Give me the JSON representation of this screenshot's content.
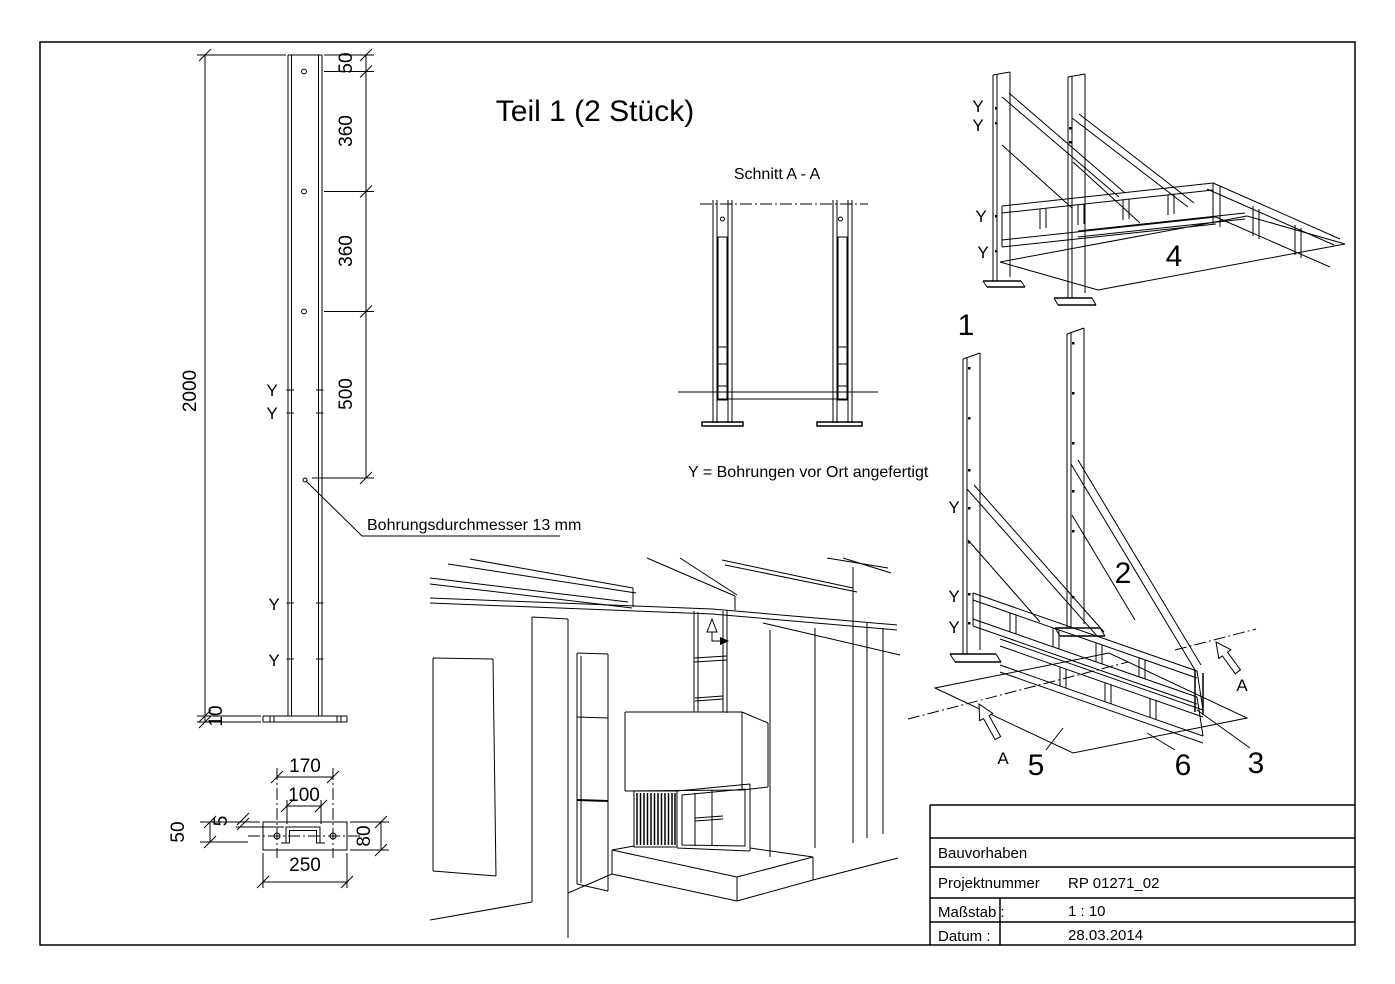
{
  "drawing": {
    "title": "Teil 1 (2 Stück)",
    "section_view_title": "Schnitt A - A",
    "note_bores_on_site": "Y = Bohrungen vor Ort angefertigt",
    "note_bore_diameter": "Bohrungsdurchmesser 13 mm",
    "bore_mark": "Y",
    "section_mark": "A"
  },
  "front_view": {
    "dim_total_height": "2000",
    "dim_top_offset": "50",
    "dim_hole_spacing_1": "360",
    "dim_hole_spacing_2": "360",
    "dim_hole_spacing_3": "500",
    "dim_base_plate_thickness": "10"
  },
  "base_plate_view": {
    "dim_plate_length": "250",
    "dim_hole_distance": "170",
    "dim_channel_width": "100",
    "dim_plate_width": "80",
    "dim_hole_offset": "50",
    "dim_lip": "5"
  },
  "part_labels": {
    "p1": "1",
    "p2": "2",
    "p3": "3",
    "p4": "4",
    "p5": "5",
    "p6": "6"
  },
  "title_block": {
    "project_label": "Bauvorhaben",
    "project_number_label": "Projektnummer",
    "project_number_value": "RP 01271_02",
    "scale_label": "Maßstab :",
    "scale_value": "1 : 10",
    "date_label": "Datum :",
    "date_value": "28.03.2014"
  }
}
